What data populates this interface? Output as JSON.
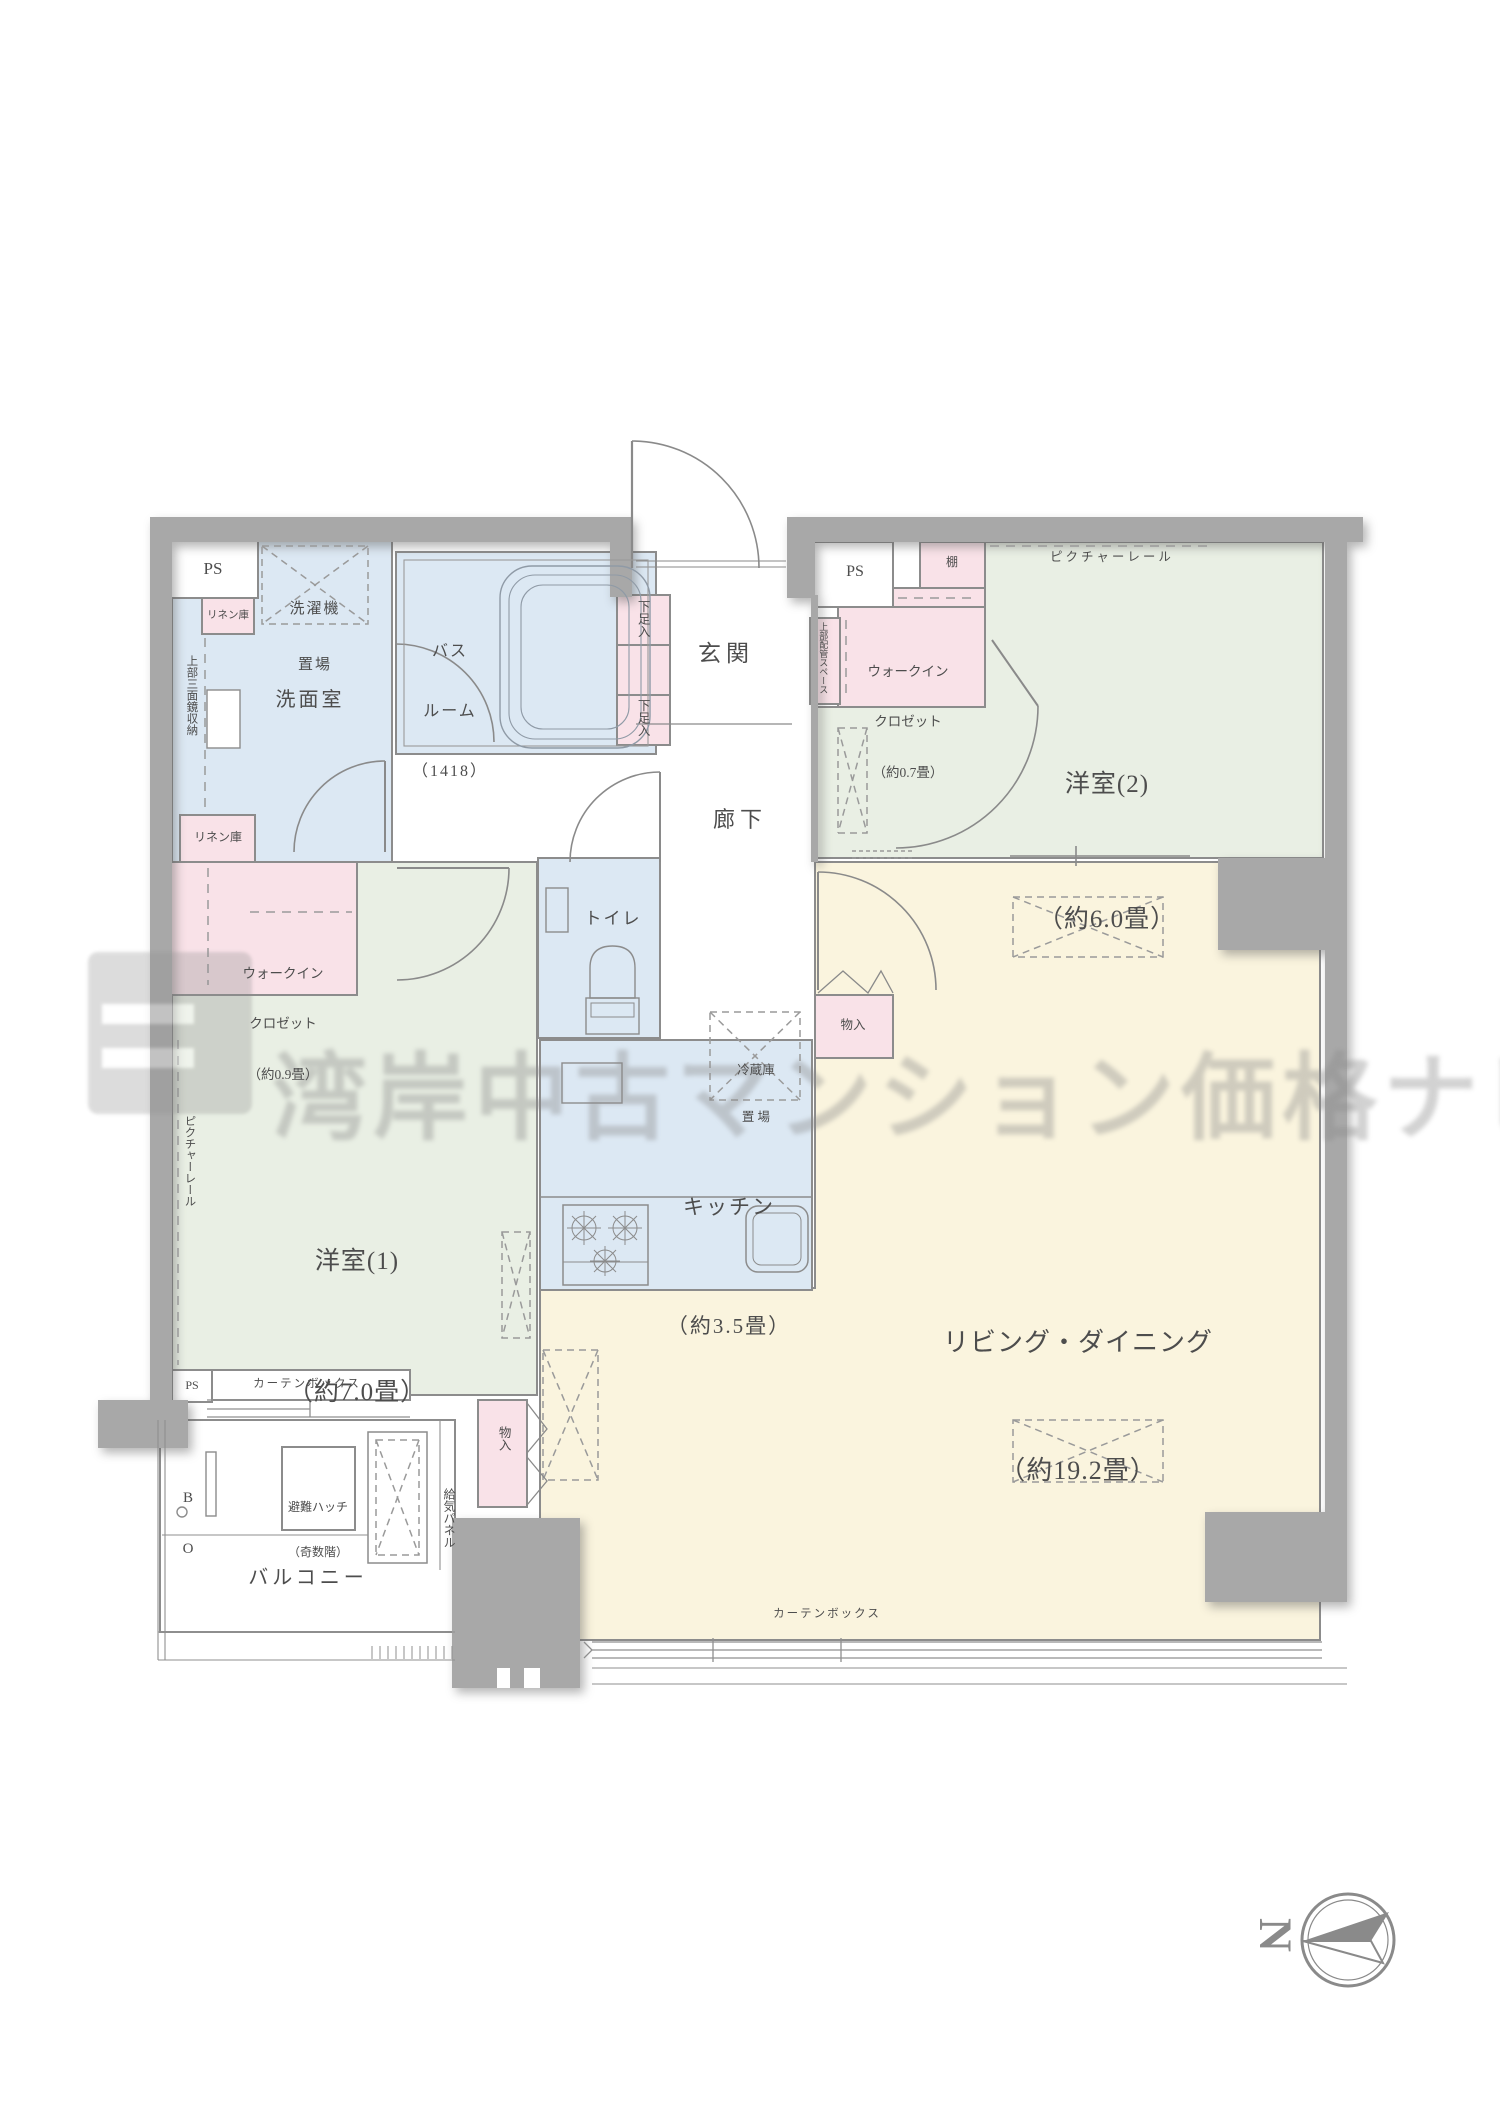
{
  "watermark": {
    "text": "湾岸中古マンション価格ナビ"
  },
  "compass": {
    "north": "N"
  },
  "colors": {
    "wall": "#a8a8a8",
    "room_outline": "#8c8c8c",
    "water_blue": "#dce8f3",
    "bedroom_green": "#e9efe4",
    "living_yellow": "#faf4de",
    "storage_pink": "#f9e2e8",
    "text": "#4d4d4d"
  },
  "labels": {
    "ps_top_left": "PS",
    "laundry": {
      "l1": "洗濯機",
      "l2": "置場"
    },
    "bathroom": {
      "l1": "バス",
      "l2": "ルーム",
      "l3": "（1418）"
    },
    "washroom": "洗面室",
    "linen_top": "リネン庫",
    "mirror_cabinet": "上部三面鏡収納",
    "linen_bottom": "リネン庫",
    "shoe_top": "下足入",
    "shoe_bottom": "下足入",
    "entrance": "玄関",
    "ps_top_right": "PS",
    "shelf": "棚",
    "pipe_space": "上部配管スペース",
    "wic2": {
      "l1": "ウォークイン",
      "l2": "クロゼット",
      "l3": "（約0.7畳）"
    },
    "bedroom2": {
      "l1": "洋室(2)",
      "l2": "（約6.0畳）"
    },
    "picture_rail_top": "ピクチャーレール",
    "hallway": "廊下",
    "toilet": "トイレ",
    "wic1": {
      "l1": "ウォークイン",
      "l2": "クロゼット",
      "l3": "（約0.9畳）"
    },
    "bedroom1": {
      "l1": "洋室(1)",
      "l2": "（約7.0畳）"
    },
    "picture_rail_left": "ピクチャーレール",
    "fridge": {
      "l1": "冷蔵庫",
      "l2": "置 場"
    },
    "kitchen": {
      "l1": "キッチン",
      "l2": "（約3.5畳）"
    },
    "storage_top": "物入",
    "storage_bottom": "物入",
    "living": {
      "l1": "リビング・ダイニング",
      "l2": "（約19.2畳）"
    },
    "curtain_box_bedroom1": "カーテンボックス",
    "curtain_box_living": "カーテンボックス",
    "ps_bottom": "PS",
    "balcony": "バルコニー",
    "hatch": {
      "l1": "避難ハッチ",
      "l2": "（奇数階）"
    },
    "air_supply_panel": "給気パネル",
    "bq": {
      "l1": "B",
      "l2": "O"
    }
  }
}
